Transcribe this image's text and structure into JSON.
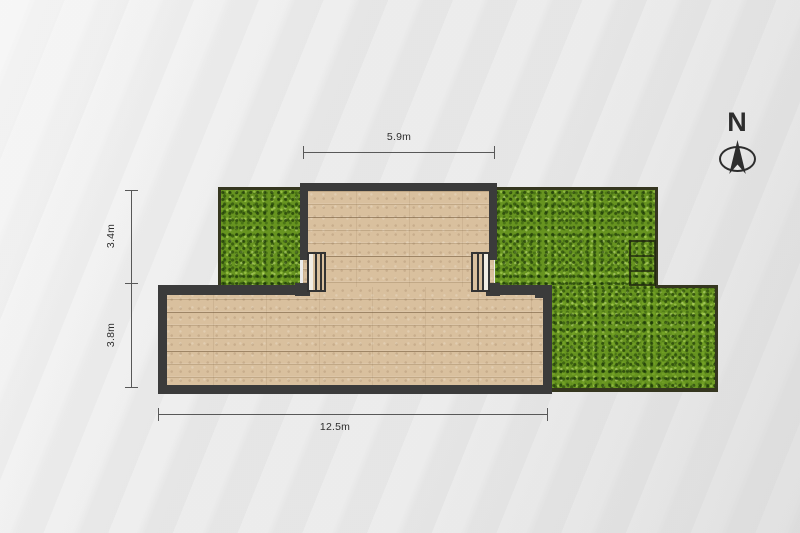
{
  "scene": {
    "description": "Top-view residential floor plan with wood decks, hedge gardens, dimension lines and a north compass"
  },
  "dimensions": {
    "top": {
      "label": "5.9m"
    },
    "left_upper": {
      "label": "3.4m"
    },
    "left_lower": {
      "label": "3.8m"
    },
    "bottom": {
      "label": "12.5m"
    }
  },
  "compass": {
    "north_label": "N",
    "icon": "north-arrow-icon"
  },
  "areas": {
    "upper_deck": "wood deck",
    "lower_deck": "wood deck",
    "left_garden": "hedge",
    "right_garden_upper": "hedge",
    "right_garden_lower": "hedge"
  },
  "colors": {
    "background": "#e9e9e9",
    "wall": "#3b3b3b",
    "wood": "#d9c09e",
    "hedge": "#679420",
    "dimension_line": "#585858",
    "text": "#2d2d2d"
  }
}
